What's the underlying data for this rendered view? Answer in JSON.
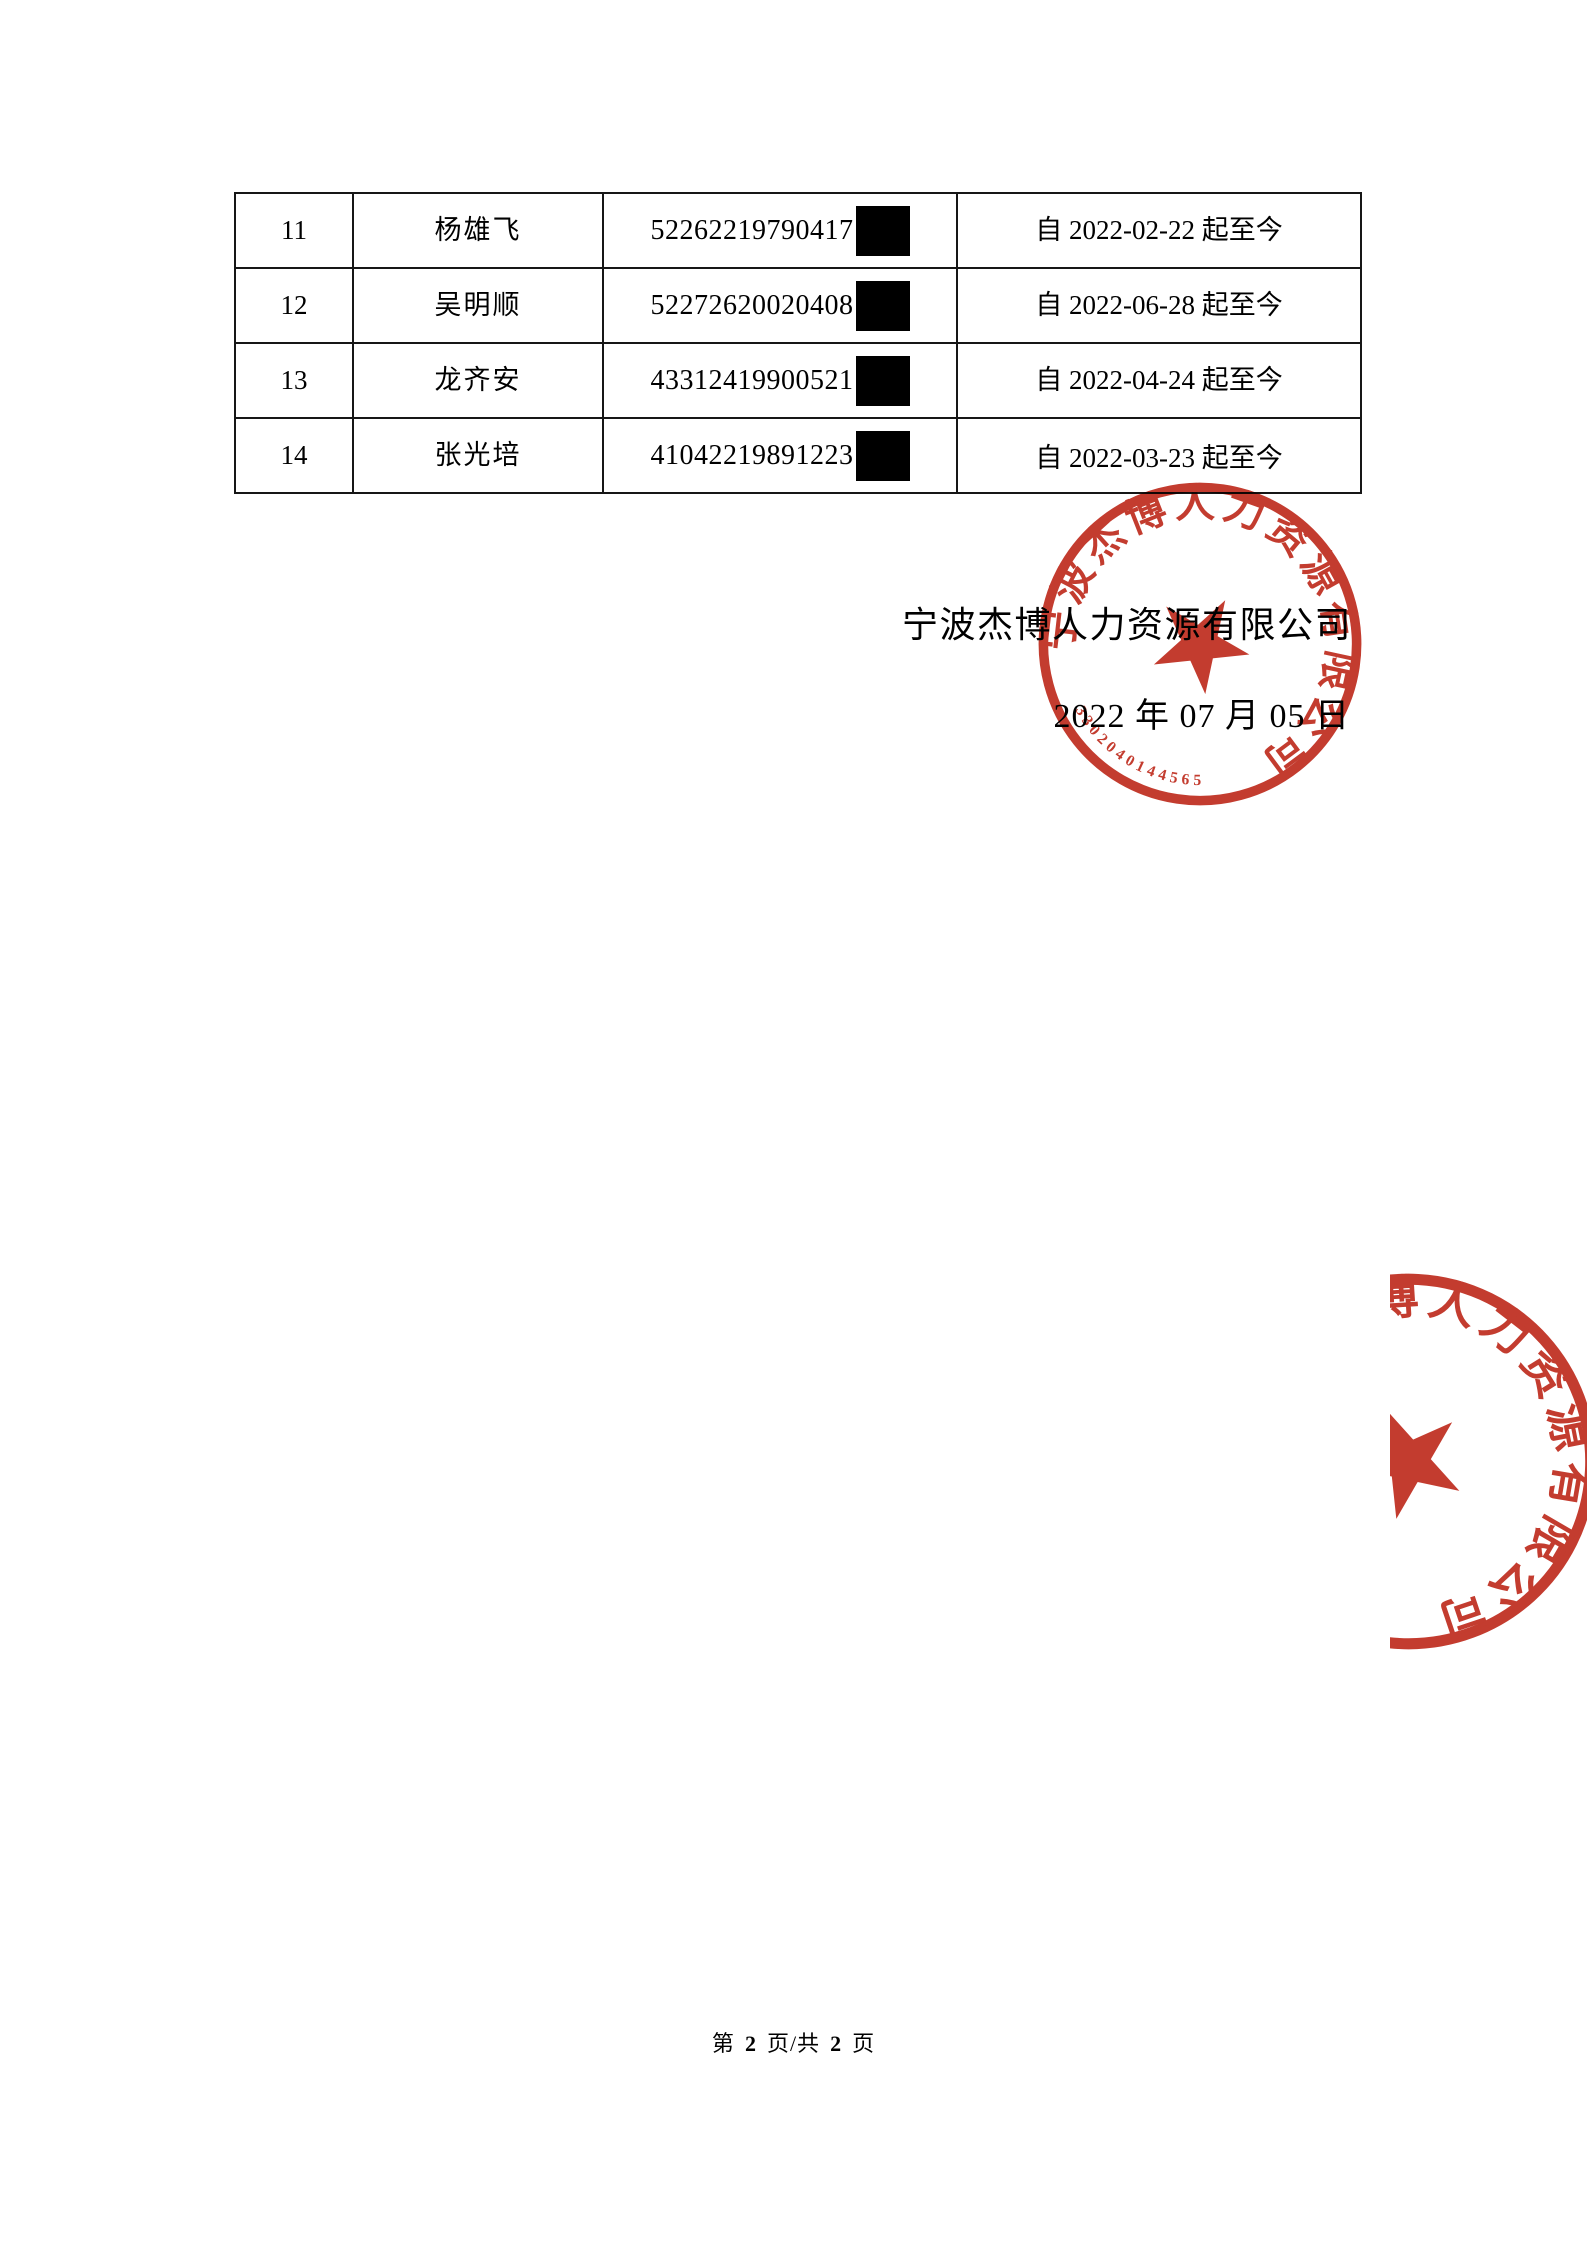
{
  "table": {
    "rows": [
      {
        "index": "11",
        "name": "杨雄飞",
        "id_number": "52262219790417",
        "period": "自 2022-02-22 起至今"
      },
      {
        "index": "12",
        "name": "吴明顺",
        "id_number": "52272620020408",
        "period": "自 2022-06-28 起至今"
      },
      {
        "index": "13",
        "name": "龙齐安",
        "id_number": "43312419900521",
        "period": "自 2022-04-24 起至今"
      },
      {
        "index": "14",
        "name": "张光培",
        "id_number": "41042219891223",
        "period": "自 2022-03-23 起至今"
      }
    ]
  },
  "signature": {
    "company": "宁波杰博人力资源有限公司",
    "date": "2022 年 07 月 05 日"
  },
  "seal": {
    "ring_text": "宁波杰博人力资源有限公司",
    "serial": "3302040144565",
    "color": "#bf2d1f"
  },
  "footer": {
    "prefix": "第",
    "page_number": "2",
    "separator": "页/共",
    "total_pages": "2",
    "suffix": "页"
  }
}
